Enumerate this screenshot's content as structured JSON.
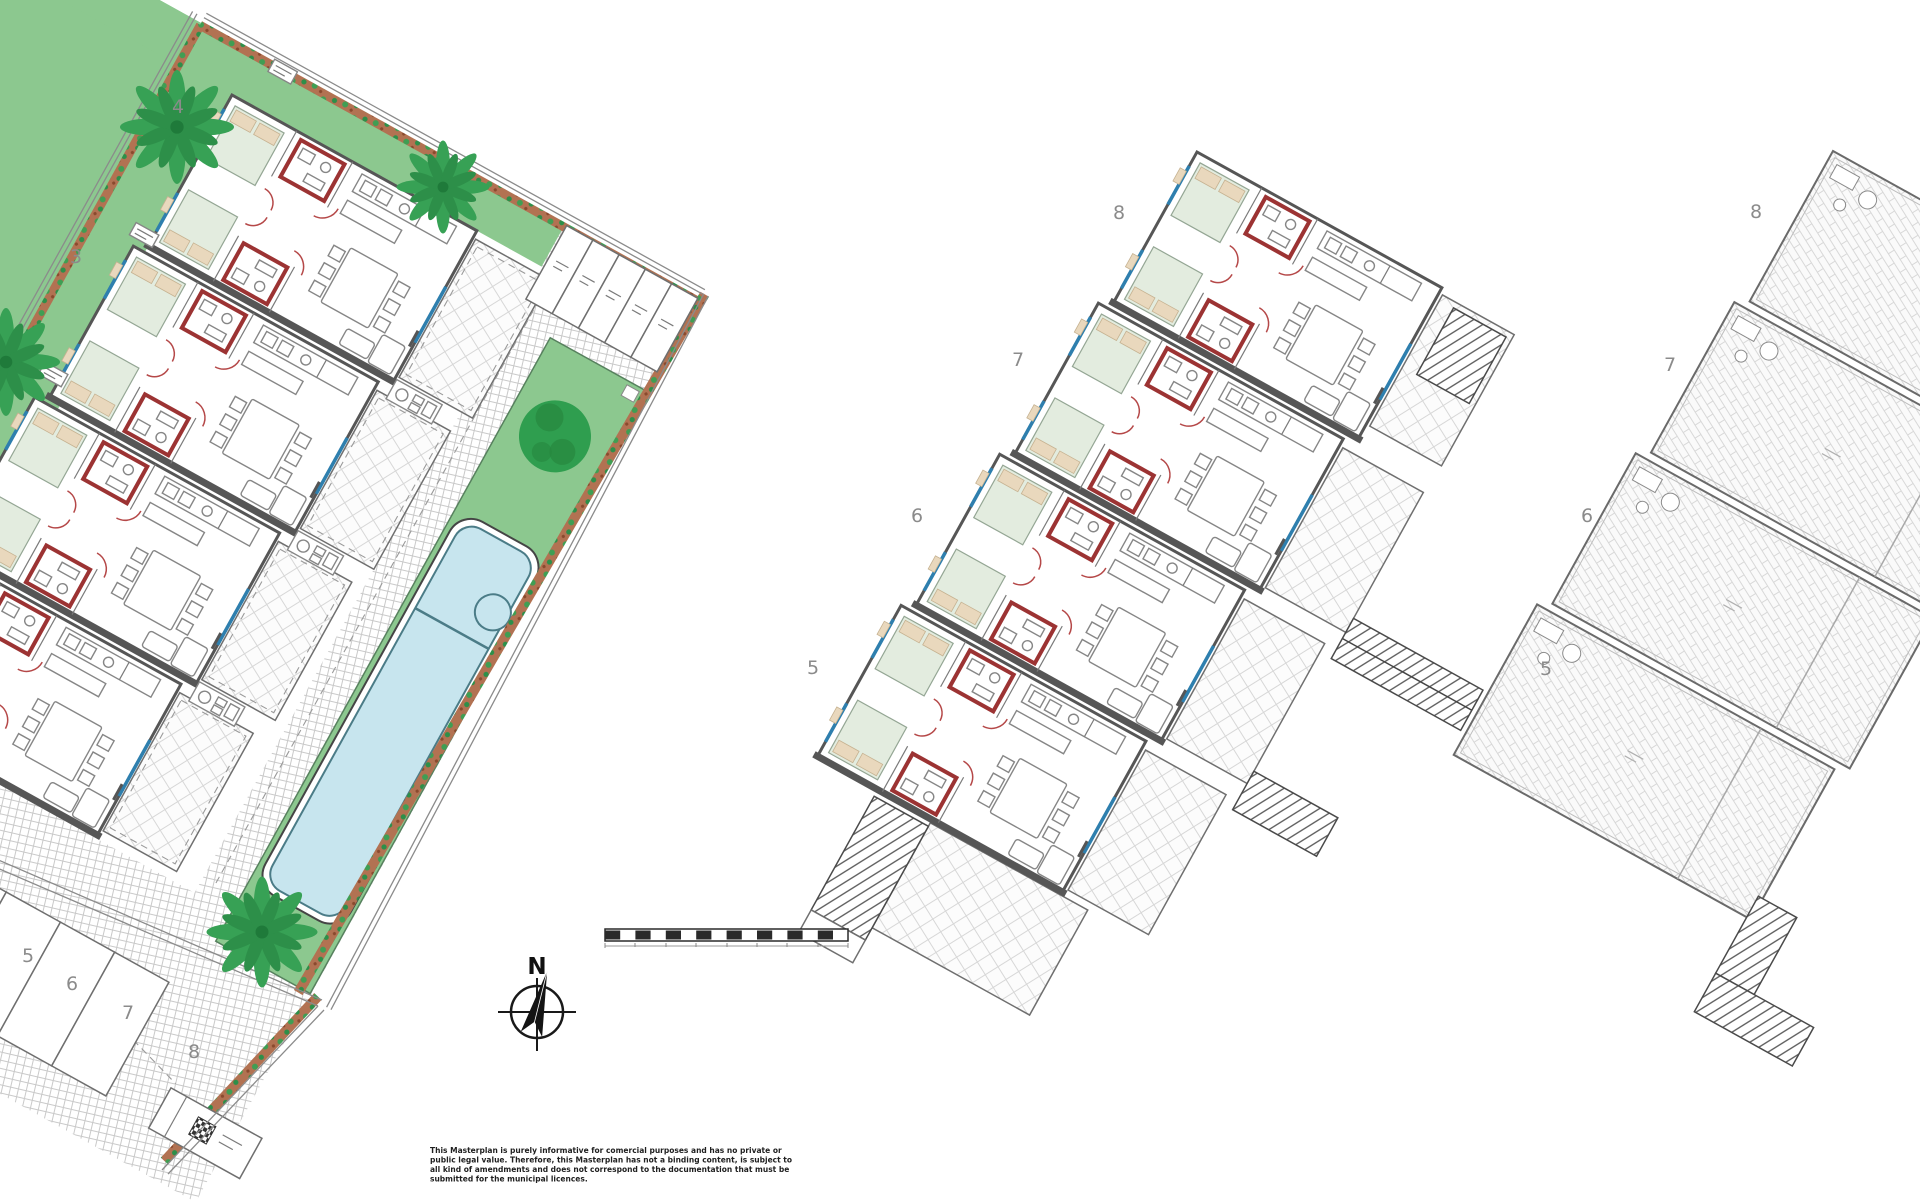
{
  "drawing": {
    "compass_north_label": "N",
    "disclaimer_lines": [
      "This Masterplan is purely informative for comercial purposes and has no private or",
      "public legal value. Therefore, this Masterplan has not a binding content, is subject to",
      "all kind of amendments and does not correspond to the documentation that must be",
      "submitted for the municipal licences."
    ]
  },
  "ground_floor_plan": {
    "unit_labels": [
      "4",
      "3"
    ],
    "parking_space_labels": [
      "5",
      "6",
      "7",
      "8"
    ]
  },
  "first_floor_plan": {
    "unit_labels": [
      "8",
      "7",
      "6",
      "5"
    ]
  },
  "roof_plan": {
    "unit_labels": [
      "8",
      "7",
      "6",
      "5"
    ]
  },
  "colors": {
    "garden_green": "#8cc88f",
    "tree_green": "#2f9e4f",
    "pool_water": "#c7e5ee",
    "pool_edge": "#4b7c87",
    "wall_gray": "#565656",
    "bathroom_red": "#9c3333",
    "window_blue": "#2e7fae",
    "flower_bed_brown": "#b27252",
    "label_gray": "#8b8b8b"
  }
}
